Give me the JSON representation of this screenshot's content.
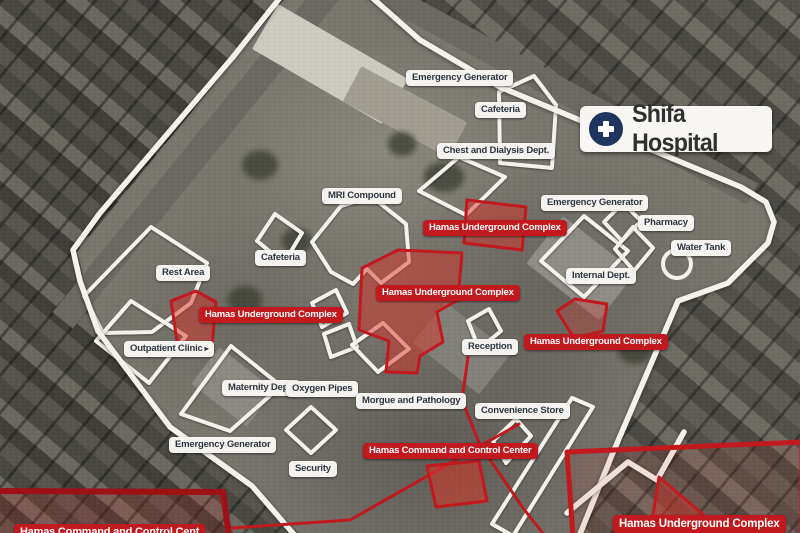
{
  "header": {
    "title": "Shifa Hospital",
    "icon": "hospital-cross-icon"
  },
  "colors": {
    "threat_red": "#c2191f",
    "threat_dark_red": "#a01116",
    "annotation_white": "#f4f2ec",
    "facility_label_bg": "#f4f3ef",
    "facility_label_text": "#2d3540",
    "badge_navy": "#1e3560"
  },
  "icons": {
    "arrow_right": "▸"
  },
  "map_labels": [
    {
      "id": "emergency-generator-top",
      "text": "Emergency Generator",
      "type": "facility",
      "x": 406,
      "y": 70
    },
    {
      "id": "cafeteria-top",
      "text": "Cafeteria",
      "type": "facility",
      "x": 475,
      "y": 102
    },
    {
      "id": "chest-dialysis-dept",
      "text": "Chest and Dialysis Dept.",
      "type": "facility",
      "x": 437,
      "y": 143
    },
    {
      "id": "mri-compound",
      "text": "MRI Compound",
      "type": "facility",
      "x": 322,
      "y": 188
    },
    {
      "id": "emergency-generator-right",
      "text": "Emergency Generator",
      "type": "facility",
      "x": 541,
      "y": 195
    },
    {
      "id": "pharmacy",
      "text": "Pharmacy",
      "type": "facility",
      "x": 638,
      "y": 215
    },
    {
      "id": "water-tank",
      "text": "Water Tank",
      "type": "facility",
      "x": 671,
      "y": 240
    },
    {
      "id": "internal-dept",
      "text": "Internal Dept.",
      "type": "facility",
      "x": 566,
      "y": 268
    },
    {
      "id": "cafeteria-2",
      "text": "Cafeteria",
      "type": "facility",
      "x": 255,
      "y": 250
    },
    {
      "id": "rest-area",
      "text": "Rest Area",
      "type": "facility",
      "x": 156,
      "y": 265
    },
    {
      "id": "outpatient-clinic",
      "text": "Outpatient Clinic",
      "type": "facility",
      "x": 124,
      "y": 341,
      "arrow": true
    },
    {
      "id": "maternity-dept",
      "text": "Maternity Dept.",
      "type": "facility",
      "x": 222,
      "y": 380
    },
    {
      "id": "oxygen-pipes",
      "text": "Oxygen Pipes",
      "type": "facility",
      "x": 286,
      "y": 381
    },
    {
      "id": "morgue-pathology",
      "text": "Morgue and Pathology",
      "type": "facility",
      "x": 356,
      "y": 393
    },
    {
      "id": "reception",
      "text": "Reception",
      "type": "facility",
      "x": 462,
      "y": 339
    },
    {
      "id": "convenience-store",
      "text": "Convenience Store",
      "type": "facility",
      "x": 475,
      "y": 403
    },
    {
      "id": "emergency-generator-bottom",
      "text": "Emergency Generator",
      "type": "facility",
      "x": 169,
      "y": 437
    },
    {
      "id": "security",
      "text": "Security",
      "type": "facility",
      "x": 289,
      "y": 461
    },
    {
      "id": "hamas-underground-top",
      "text": "Hamas Underground Complex",
      "type": "threat",
      "x": 423,
      "y": 220
    },
    {
      "id": "hamas-underground-central",
      "text": "Hamas Underground Complex",
      "type": "threat",
      "x": 376,
      "y": 285
    },
    {
      "id": "hamas-underground-left",
      "text": "Hamas Underground Complex",
      "type": "threat",
      "x": 199,
      "y": 307
    },
    {
      "id": "hamas-underground-right",
      "text": "Hamas Underground Complex",
      "type": "threat",
      "x": 524,
      "y": 334
    },
    {
      "id": "hamas-command-center",
      "text": "Hamas Command and Control Center",
      "type": "threat",
      "x": 363,
      "y": 443
    },
    {
      "id": "hamas-underground-bottomright",
      "text": "Hamas Underground Complex",
      "type": "threat",
      "x": 613,
      "y": 515,
      "size": 11.5
    },
    {
      "id": "hamas-command-bottomleft",
      "text": "Hamas Command and Control Cent",
      "type": "threat",
      "x": 14,
      "y": 524,
      "size": 11
    }
  ],
  "boundaries": [
    {
      "name": "compound-boundary-west",
      "points": "283,-6 233,57 100,213 73,250 80,281 98,331 170,427 252,486 298,539"
    },
    {
      "name": "compound-boundary-east",
      "points": "368,-6 420,40 500,87 741,187 766,202 774,222 768,243 728,283 678,301 612,455 578,539"
    },
    {
      "name": "compound-boundary-zigzag",
      "points": "567,513 628,462 657,480 684,432"
    }
  ],
  "building_outlines": [
    {
      "name": "cafeteria-top-building",
      "points": "500,163 499,92 534,76 556,105 552,168"
    },
    {
      "name": "chest-dialysis-building",
      "points": "419,191 459,157 505,177 466,215"
    },
    {
      "name": "mri-compound-building",
      "points": "312,242 341,206 372,197 406,224 409,262 381,283 367,269 353,284 331,272"
    },
    {
      "name": "cafeteria-2-building",
      "points": "257,241 275,214 302,233 284,263"
    },
    {
      "name": "rest-area-building",
      "points": "84,296 151,227 207,263 191,303 152,332 103,333"
    },
    {
      "name": "outpatient-building",
      "points": "96,341 131,301 186,336 149,383"
    },
    {
      "name": "maternity-building",
      "points": "181,414 231,346 281,386 230,431"
    },
    {
      "name": "oxygen-structure-1",
      "points": "312,303 336,290 347,313 322,327"
    },
    {
      "name": "oxygen-structure-2",
      "points": "324,334 349,324 357,347 331,357"
    },
    {
      "name": "morgue-building",
      "points": "352,345 383,323 409,349 378,372"
    },
    {
      "name": "security-building",
      "points": "286,430 311,407 336,430 311,453"
    },
    {
      "name": "internal-dept-building",
      "points": "541,261 584,216 628,251 584,297"
    },
    {
      "name": "emergency-generator-right-building",
      "points": "604,222 623,203 641,221 622,241"
    },
    {
      "name": "pharmacy-building",
      "points": "615,249 633,227 653,248 634,271"
    },
    {
      "name": "reception-building",
      "points": "468,321 489,309 501,331 479,349"
    },
    {
      "name": "convenience-long-building",
      "points": "572,398 593,407 513,536 492,524"
    },
    {
      "name": "convenience-corner-building",
      "points": "493,441 516,419 531,436 506,463"
    }
  ],
  "water_tank_marker": {
    "cx": 677,
    "cy": 264,
    "r": 14
  },
  "threat_zones": [
    {
      "name": "zone-underground-central",
      "points": "362,268 398,250 462,253 458,300 437,312 443,342 420,356 417,373 386,372 389,341 359,330",
      "fill": 0.5
    },
    {
      "name": "zone-underground-top",
      "points": "467,200 526,207 522,250 464,243",
      "fill": 0.5
    },
    {
      "name": "zone-underground-right",
      "points": "557,311 575,299 607,304 603,331 574,338",
      "fill": 0.3
    },
    {
      "name": "zone-underground-left",
      "points": "171,301 196,291 216,302 212,346 178,348",
      "fill": 0.5
    },
    {
      "name": "zone-command-area",
      "points": "427,466 479,461 487,501 436,507",
      "fill": 0.55
    },
    {
      "name": "zone-bottomright-triangle",
      "points": "651,528 659,477 719,528",
      "fill": 0.45
    },
    {
      "name": "zone-bottomright-box",
      "points": "567,452 802,442 802,536 573,536",
      "fill": 0.1,
      "stroke_width": 5
    },
    {
      "name": "zone-bottomleft-box",
      "points": "-4,491 223,492 229,536 -4,536",
      "fill": 0.18,
      "stroke_width": 6,
      "dark": true
    }
  ],
  "tunnel_lines": [
    {
      "name": "tunnel-line-reception",
      "points": "468,357 462,400 480,445 523,508 545,536"
    },
    {
      "name": "tunnel-line-command",
      "points": "519,424 350,520 232,528"
    }
  ]
}
